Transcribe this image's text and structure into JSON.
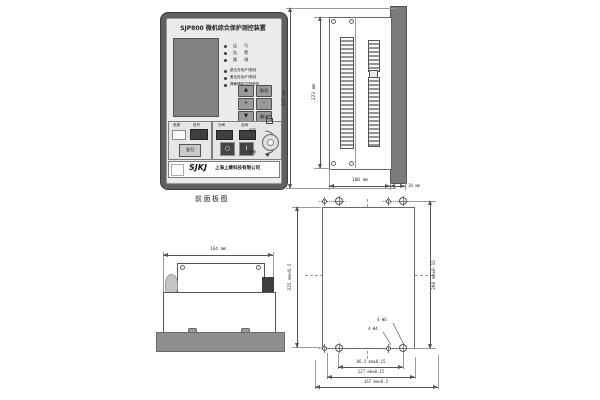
{
  "front_panel": {
    "title": "SJP800 微机综合保护测控装置",
    "caption": "前面板图",
    "leds_status": [
      "运 行",
      "告 警",
      "跳 闸"
    ],
    "leds_info": [
      "重合充电/PT断线",
      "备自充电/PT断线",
      "弹簧储能/控回断线"
    ],
    "keypad": {
      "up": "▲",
      "cancel": "取消",
      "plus": "+",
      "minus": "−",
      "down": "▼",
      "confirm": "确认"
    },
    "signal_section": {
      "power_label": "电源",
      "signal_label": "信号",
      "reset_button": "复归"
    },
    "control_section": {
      "open_label": "分闸",
      "close_label": "合闸",
      "off_symbol": "○",
      "on_symbol": "I",
      "dial_label_remote": "远方",
      "dial_label_local": "就地"
    },
    "brand": {
      "logo": "SJKJ",
      "company": "上海上继科技有限公司"
    }
  },
  "side_view": {
    "overall_height": "266 mm",
    "case_height": "223 mm",
    "case_depth": "100 mm",
    "panel_thickness": "10 mm"
  },
  "top_view": {
    "body_width": "164 mm"
  },
  "cutout": {
    "cutout_height": "225 mm+0.5",
    "hole_span_height": "208 mm±0.15",
    "hole_span_inner": "86.5 mm±0.15",
    "hole_span_outer": "127 mm±0.15",
    "cutout_width": "167 mm+0.5",
    "hole_label_large": "4-Φ6",
    "hole_label_small": "4-Φ4"
  }
}
